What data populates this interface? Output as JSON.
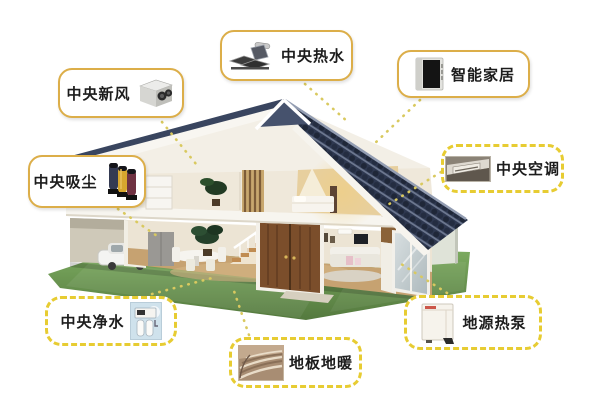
{
  "diagram": {
    "type": "smart-home-systems-cutaway",
    "callouts": [
      {
        "label": "中央新风",
        "icon": "fresh-air-unit-icon",
        "border_style": "solid"
      },
      {
        "label": "中央热水",
        "icon": "solar-water-heater-icon",
        "border_style": "solid"
      },
      {
        "label": "智能家居",
        "icon": "smart-home-panel-icon",
        "border_style": "solid"
      },
      {
        "label": "中央吸尘",
        "icon": "vacuum-cylinders-icon",
        "border_style": "solid"
      },
      {
        "label": "中央空调",
        "icon": "ceiling-ac-icon",
        "border_style": "dashed"
      },
      {
        "label": "中央净水",
        "icon": "water-purifier-icon",
        "border_style": "dashed"
      },
      {
        "label": "地板地暖",
        "icon": "floor-heating-icon",
        "border_style": "dashed"
      },
      {
        "label": "地源热泵",
        "icon": "ground-heat-pump-icon",
        "border_style": "dashed"
      }
    ],
    "colors": {
      "solid_box_border": "#dcae49",
      "dashed_box_border": "#e7cc32",
      "connector_dots": "#d9c95f",
      "roof": "#3a465f",
      "lawn": "#6f9e55",
      "label_text": "#1c1c1c",
      "background": "#ffffff"
    }
  }
}
